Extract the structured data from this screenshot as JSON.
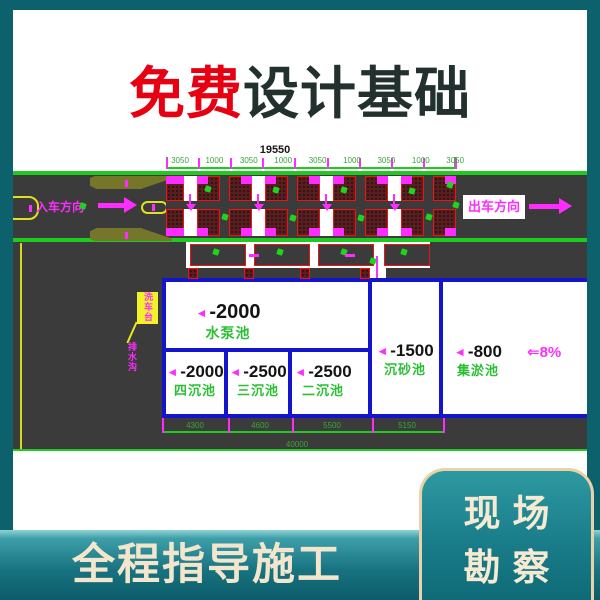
{
  "page": {
    "title_highlight": "免费",
    "title_rest": "设计基础",
    "bottom_banner": "全程指导施工",
    "corner_card_line1": "现场",
    "corner_card_line2": "勘察"
  },
  "drawing": {
    "overall_width_dim": "19550",
    "top_segments": [
      "3050",
      "1000",
      "3050",
      "1000",
      "3050",
      "1000",
      "3050",
      "1000",
      "3050"
    ],
    "entry_direction": "入车方向",
    "exit_direction": "出车方向",
    "callout_label": "洗车台",
    "drain_label": "排水沟",
    "pools": {
      "pump": {
        "elevation": "-2000",
        "name": "水泵池"
      },
      "fourth": {
        "elevation": "-2000",
        "name": "四沉池"
      },
      "third": {
        "elevation": "-2500",
        "name": "三沉池"
      },
      "second": {
        "elevation": "-2500",
        "name": "二沉池"
      },
      "grit": {
        "elevation": "-1500",
        "name": "沉砂池"
      },
      "sludge": {
        "elevation": "-800",
        "name": "集淤池"
      }
    },
    "slope": "8%",
    "bottom_segments": [
      "4300",
      "4600",
      "5500",
      "5150"
    ],
    "overall_length_dim": "40000"
  },
  "icons": {
    "elevation_triangle": "◄",
    "slope_arrow": "⇐"
  },
  "colors": {
    "frame_teal": "#0d616c",
    "title_red": "#e60012",
    "title_dark": "#23312e",
    "road_gray": "#3b3b3b",
    "cad_green": "#1ecb1e",
    "cad_magenta": "#ff2cff",
    "cad_red": "#ef1212",
    "wall_blue": "#1414cc",
    "cream": "#f3e6cc"
  }
}
